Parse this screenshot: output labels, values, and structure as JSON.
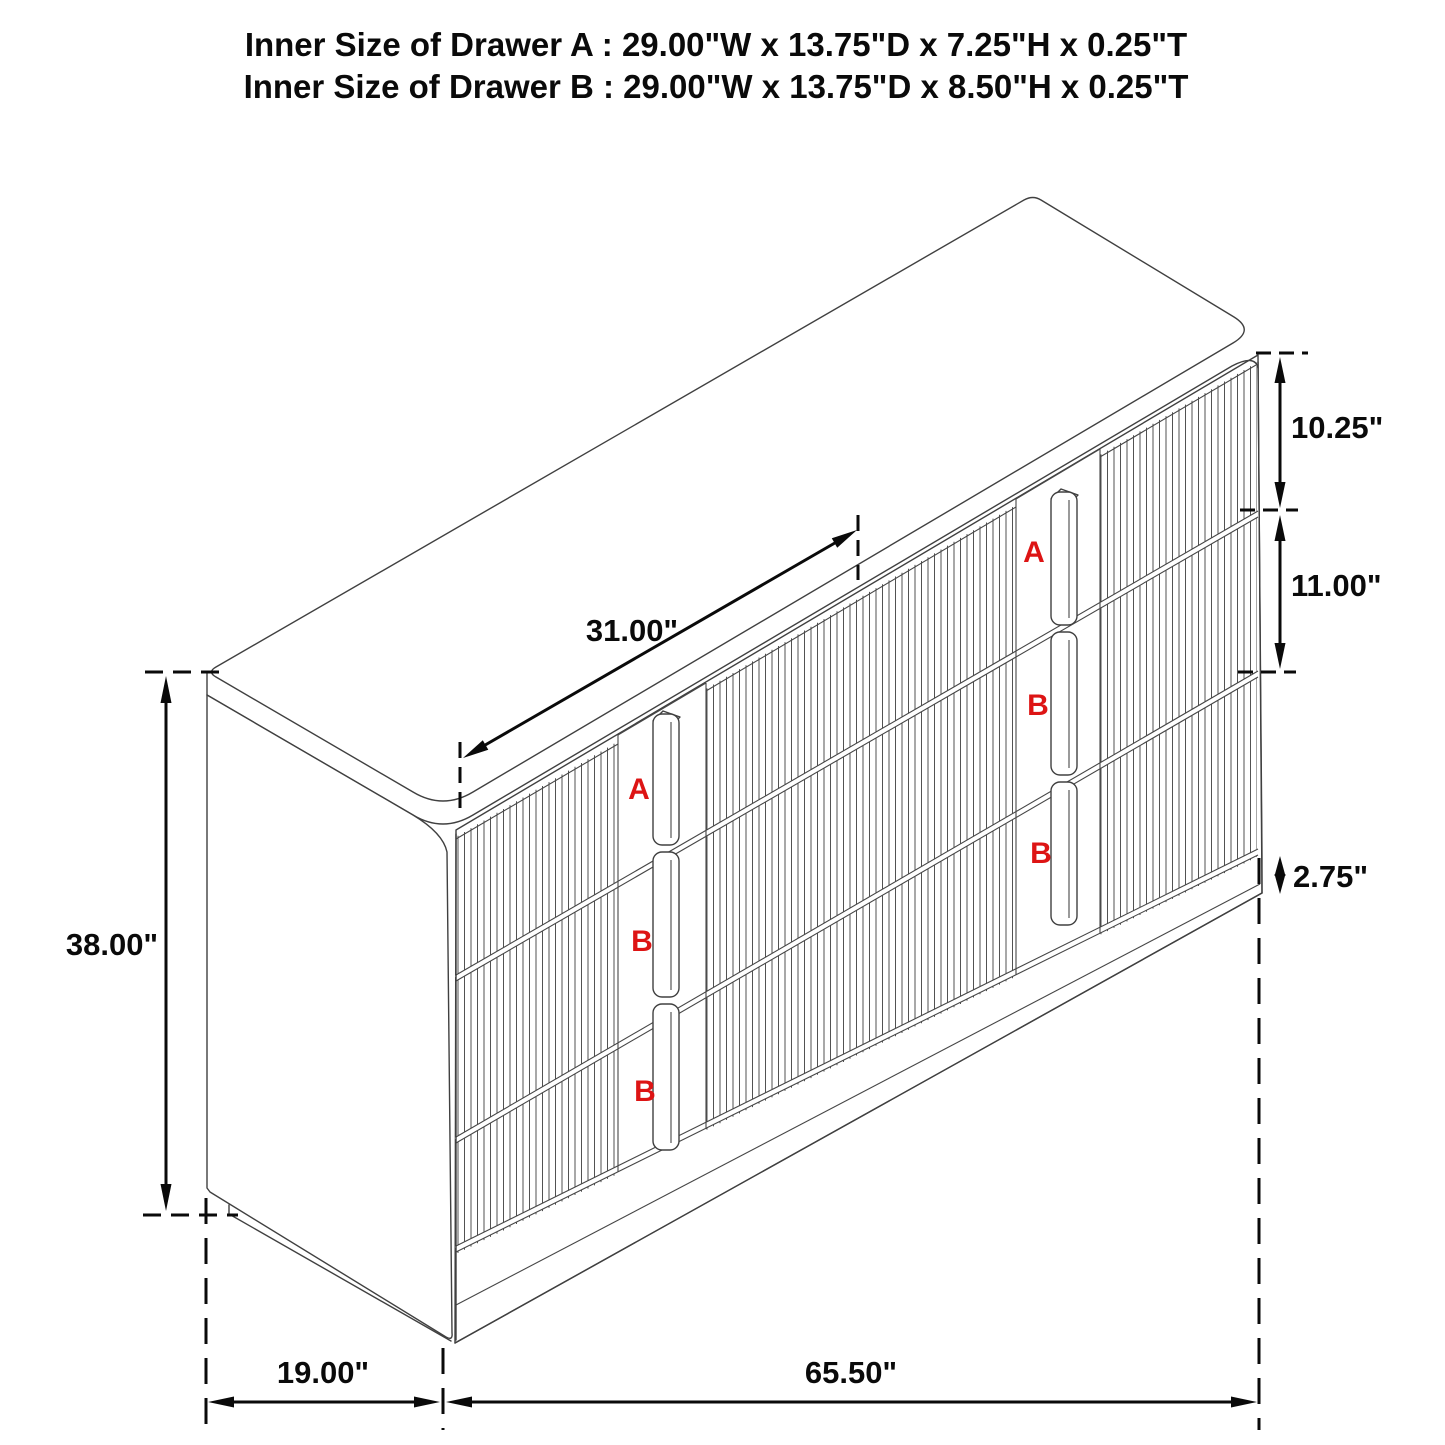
{
  "title": {
    "line1": "Inner Size of Drawer A : 29.00\"W x 13.75\"D x 7.25\"H x 0.25\"T",
    "line2": "Inner Size of Drawer B : 29.00\"W x 13.75\"D x 8.50\"H x 0.25\"T"
  },
  "dimensions": {
    "top_drawer_height": "10.25\"",
    "middle_drawer_height": "11.00\"",
    "base_height": "2.75\"",
    "overall_height": "38.00\"",
    "middle_drawer_width": "31.00\"",
    "depth": "19.00\"",
    "overall_width": "65.50\""
  },
  "drawer_labels": {
    "left_column": [
      "A",
      "B",
      "B"
    ],
    "right_column": [
      "A",
      "B",
      "B"
    ]
  },
  "colors": {
    "label_red": "#dd1414",
    "line": "#404040",
    "dimension": "#0a0a0a",
    "background": "#ffffff"
  }
}
